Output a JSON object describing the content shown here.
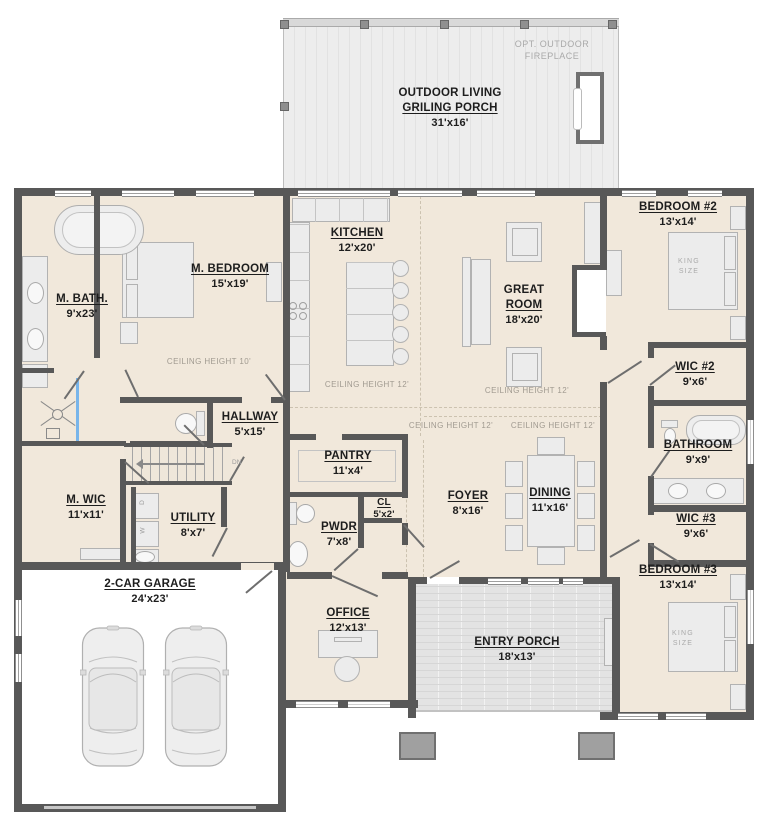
{
  "colors": {
    "floor": "#f1e8db",
    "wall": "#585858",
    "deck": "#ececec",
    "entry_porch": "#e3e3e3",
    "furniture": "#ececec",
    "shower_glass": "#79b5ea"
  },
  "rooms": {
    "outdoor_living": {
      "title1": "OUTDOOR LIVING",
      "title2": "GRILING PORCH",
      "dims": "31'x16'"
    },
    "m_bath": {
      "title": "M. BATH.",
      "dims": "9'x23'"
    },
    "m_bedroom": {
      "title": "M. BEDROOM",
      "dims": "15'x19'"
    },
    "kitchen": {
      "title": "KITCHEN",
      "dims": "12'x20'"
    },
    "great_room": {
      "title1": "GREAT",
      "title2": "ROOM",
      "dims": "18'x20'"
    },
    "bedroom_2": {
      "title": "BEDROOM #2",
      "dims": "13'x14'"
    },
    "wic_2": {
      "title": "WIC #2",
      "dims": "9'x6'"
    },
    "bathroom": {
      "title": "BATHROOM",
      "dims": "9'x9'"
    },
    "wic_3": {
      "title": "WIC #3",
      "dims": "9'x6'"
    },
    "bedroom_3": {
      "title": "BEDROOM #3",
      "dims": "13'x14'"
    },
    "hallway": {
      "title": "HALLWAY",
      "dims": "5'x15'"
    },
    "pantry": {
      "title": "PANTRY",
      "dims": "11'x4'"
    },
    "closet": {
      "title": "CL",
      "dims": "5'x2'"
    },
    "powder": {
      "title": "PWDR",
      "dims": "7'x8'"
    },
    "foyer": {
      "title": "FOYER",
      "dims": "8'x16'"
    },
    "dining": {
      "title": "DINING",
      "dims": "11'x16'"
    },
    "m_wic": {
      "title": "M. WIC",
      "dims": "11'x11'"
    },
    "utility": {
      "title": "UTILITY",
      "dims": "8'x7'"
    },
    "garage": {
      "title": "2-CAR GARAGE",
      "dims": "24'x23'"
    },
    "office": {
      "title": "OFFICE",
      "dims": "12'x13'"
    },
    "entry_porch": {
      "title": "ENTRY PORCH",
      "dims": "18'x13'"
    }
  },
  "annotations": {
    "opt_fireplace1": "OPT. OUTDOOR",
    "opt_fireplace2": "FIREPLACE",
    "ceiling_10": "CEILING HEIGHT 10'",
    "ceiling_12": "CEILING HEIGHT 12'",
    "king": "KING",
    "size": "SIZE",
    "down": "DN",
    "washer": "W",
    "dryer": "D"
  }
}
